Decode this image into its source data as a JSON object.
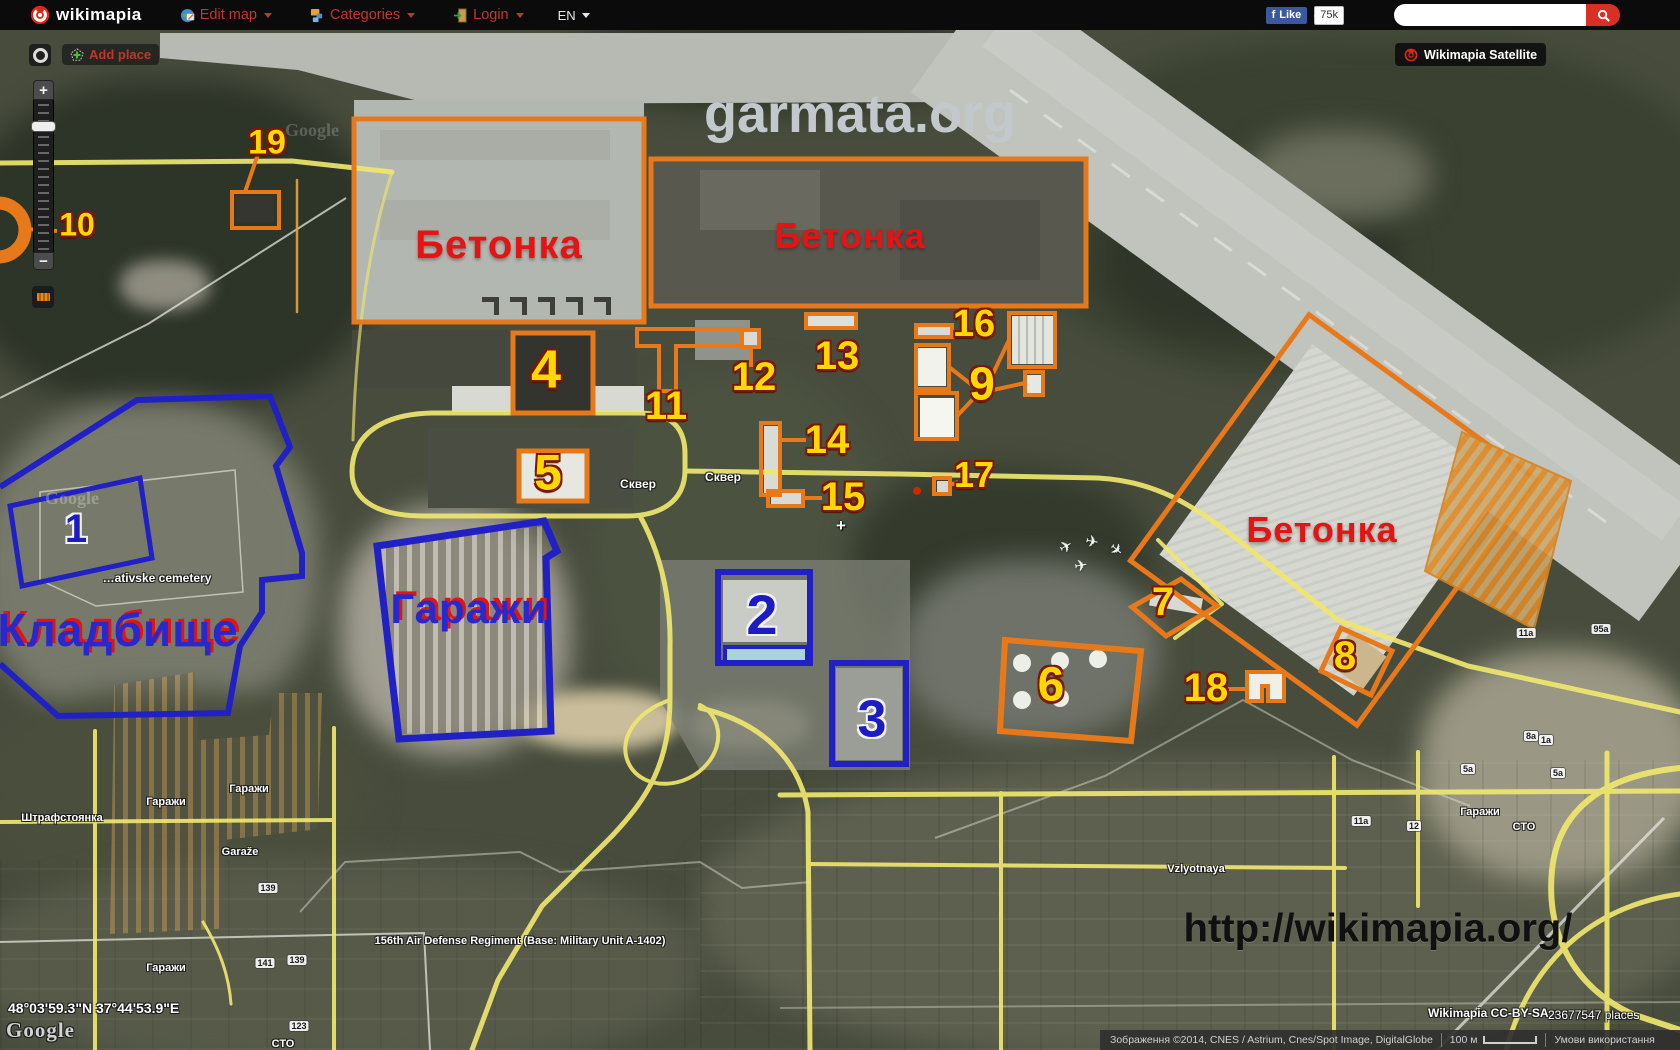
{
  "header": {
    "brand": "wikimapia",
    "edit_map": "Edit map",
    "categories": "Categories",
    "login": "Login",
    "lang": "EN",
    "like_f": "f",
    "like": "Like",
    "like_count": "75k",
    "search_value": ""
  },
  "map_controls": {
    "add_place": "Add place",
    "satellite": "Wikimapia Satellite",
    "zoom_in": "+",
    "zoom_out": "−"
  },
  "annotations": {
    "numbers_orange": [
      {
        "n": "4",
        "x": 546,
        "y": 372,
        "s": 54
      },
      {
        "n": "5",
        "x": 548,
        "y": 475,
        "s": 50
      },
      {
        "n": "6",
        "x": 1051,
        "y": 688,
        "s": 48
      },
      {
        "n": "7",
        "x": 1163,
        "y": 604,
        "s": 40
      },
      {
        "n": "8",
        "x": 1345,
        "y": 658,
        "s": 40
      },
      {
        "n": "9",
        "x": 982,
        "y": 386,
        "s": 46
      },
      {
        "n": "10",
        "x": 77,
        "y": 226,
        "s": 32
      },
      {
        "n": "11",
        "x": 666,
        "y": 408,
        "s": 40
      },
      {
        "n": "12",
        "x": 754,
        "y": 379,
        "s": 40
      },
      {
        "n": "13",
        "x": 837,
        "y": 358,
        "s": 40
      },
      {
        "n": "14",
        "x": 827,
        "y": 442,
        "s": 40
      },
      {
        "n": "15",
        "x": 843,
        "y": 499,
        "s": 40
      },
      {
        "n": "16",
        "x": 974,
        "y": 326,
        "s": 38
      },
      {
        "n": "17",
        "x": 974,
        "y": 477,
        "s": 36
      },
      {
        "n": "18",
        "x": 1206,
        "y": 690,
        "s": 40
      },
      {
        "n": "19",
        "x": 267,
        "y": 144,
        "s": 34
      }
    ],
    "numbers_blue": [
      {
        "n": "1",
        "x": 76,
        "y": 531,
        "s": 40
      },
      {
        "n": "2",
        "x": 762,
        "y": 618,
        "s": 56
      },
      {
        "n": "3",
        "x": 872,
        "y": 722,
        "s": 52
      }
    ],
    "big_labels": [
      {
        "t": "Бетонка",
        "x": 499,
        "y": 245,
        "s": 40,
        "c": "red"
      },
      {
        "t": "Бетонка",
        "x": 850,
        "y": 236,
        "s": 36,
        "c": "red"
      },
      {
        "t": "Бетонка",
        "x": 1322,
        "y": 530,
        "s": 36,
        "c": "red"
      },
      {
        "t": "Кладбище",
        "x": 118,
        "y": 630,
        "s": 46,
        "c": "bluered"
      },
      {
        "t": "Гаражи",
        "x": 469,
        "y": 609,
        "s": 42,
        "c": "bluered"
      }
    ],
    "small_labels": [
      {
        "t": "Сквер",
        "x": 638,
        "y": 484,
        "s": 12
      },
      {
        "t": "Сквер",
        "x": 723,
        "y": 477,
        "s": 12
      },
      {
        "t": "…ativske cemetery",
        "x": 157,
        "y": 578,
        "s": 12
      },
      {
        "t": "Штрафстоянка",
        "x": 62,
        "y": 818,
        "s": 11
      },
      {
        "t": "Гаражи",
        "x": 166,
        "y": 802,
        "s": 11
      },
      {
        "t": "Гаражи",
        "x": 249,
        "y": 789,
        "s": 11
      },
      {
        "t": "Гаражи",
        "x": 166,
        "y": 968,
        "s": 11
      },
      {
        "t": "Гаражи",
        "x": 1480,
        "y": 812,
        "s": 11
      },
      {
        "t": "Garaže",
        "x": 240,
        "y": 852,
        "s": 11
      },
      {
        "t": "156th Air Defense Regiment (Base: Military Unit A-1402)",
        "x": 520,
        "y": 941,
        "s": 11
      },
      {
        "t": "Vzlyotnaya",
        "x": 1196,
        "y": 869,
        "s": 11
      },
      {
        "t": "СТО",
        "x": 1524,
        "y": 827,
        "s": 11
      },
      {
        "t": "СТО",
        "x": 283,
        "y": 1044,
        "s": 11
      }
    ],
    "address_chips": [
      {
        "t": "141",
        "x": 265,
        "y": 963
      },
      {
        "t": "139",
        "x": 297,
        "y": 960
      },
      {
        "t": "139",
        "x": 268,
        "y": 888
      },
      {
        "t": "123",
        "x": 299,
        "y": 1026
      },
      {
        "t": "95a",
        "x": 1601,
        "y": 629
      },
      {
        "t": "11a",
        "x": 1526,
        "y": 633
      },
      {
        "t": "8a",
        "x": 1531,
        "y": 736
      },
      {
        "t": "1a",
        "x": 1546,
        "y": 740
      },
      {
        "t": "5a",
        "x": 1468,
        "y": 769
      },
      {
        "t": "5a",
        "x": 1558,
        "y": 773
      },
      {
        "t": "11a",
        "x": 1361,
        "y": 821
      },
      {
        "t": "12",
        "x": 1414,
        "y": 826
      }
    ],
    "plane_glyph": "✈",
    "planes": [
      {
        "x": 1066,
        "y": 547,
        "r": -30
      },
      {
        "x": 1092,
        "y": 542,
        "r": 10
      },
      {
        "x": 1116,
        "y": 550,
        "r": 40
      },
      {
        "x": 1081,
        "y": 566,
        "r": -10
      }
    ]
  },
  "watermarks": {
    "garmata": "garmata.org",
    "url": "http://wikimapia.org/",
    "google": "Google"
  },
  "footer": {
    "coords": "48°03'59.3\"N 37°44'53.9\"E",
    "google": "Google",
    "license": "Wikimapia CC-BY-SA",
    "places": "23677547 places",
    "attribution": "Зображення ©2014, CNES / Astrium, Cnes/Spot Image, DigitalGlobe",
    "scale": "100 м",
    "terms": "Умови використання"
  },
  "colors": {
    "annotation_orange": "#e8791a",
    "annotation_blue": "#2020c4",
    "number_yellow": "#ffd800",
    "label_red": "#e41414",
    "roads_yellow": "#efe76f"
  }
}
